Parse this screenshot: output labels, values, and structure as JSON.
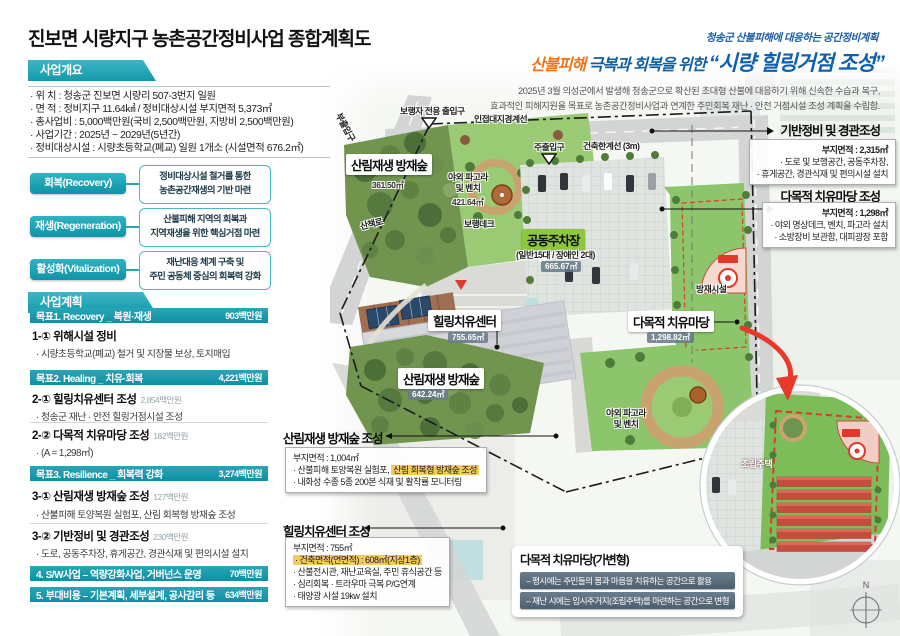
{
  "colors": {
    "accent_teal": "#1ba3b4",
    "slogan_blue": "#0e5fae",
    "slogan_orange": "#ee7318",
    "highlight_yellow": "#f3ca5d",
    "alert_red": "#e8392b",
    "parking_green": "#8dc63f"
  },
  "title": "진보면 시량지구 농촌공간정비사업 종합계획도",
  "slogan": {
    "kicker": "청송군 산불피해에 대응하는 공간정비계획",
    "highlight": "산불피해",
    "mid": " 극복과 회복을 위한 ",
    "quoted": "“시량 힐링거점 조성”",
    "desc1": "2025년 3월 의성군에서 발생해 청송군으로 확산된 초대형 산불에 대응하기 위해 신속한 수습과 복구,",
    "desc2": "효과적인 피해지원을 목표로 농촌공간정비사업과 연계한 주민회복 재난 · 안전 거점시설 조성 계획을 수립함."
  },
  "overview": {
    "tab": "사업개요",
    "items": [
      "· 위    치 : 청송군 진보면 시량리 507-3번지 일원",
      "· 면    적 : 정비지구 11.64㎢ / 정비대상시설 부지면적 5,373㎡",
      "· 총사업비 : 5,000백만원(국비 2,500백만원, 지방비 2,500백만원)",
      "· 사업기간 : 2025년 ~ 2029년(5년간)",
      "· 정비대상시설 : 시량초등학교(폐교) 일원 1개소 (시설면적 676.2㎡)"
    ]
  },
  "strategies": [
    {
      "label": "회복(Recovery)",
      "line1": "정비대상시설 철거를 통한",
      "line2": "농촌공간재생의 기반 마련"
    },
    {
      "label": "재생(Regeneration)",
      "line1": "산불피해 지역의 회복과",
      "line2": "지역재생을 위한 핵심거점 마련"
    },
    {
      "label": "활성화(Vitalization)",
      "line1": "재난대응 체계 구축 및",
      "line2": "주민 공동체 중심의 회복력 강화"
    }
  ],
  "plan": {
    "tab": "사업계획",
    "goal1": {
      "label": "목표1. Recovery _ 복원·재생",
      "amount": "903백만원"
    },
    "item1": {
      "title": "1-① 위해시설 정비",
      "amount": "",
      "sub": "· 시량초등학교(폐교) 철거 및 지장물 보상, 토지매입"
    },
    "goal2": {
      "label": "목표2. Healing _ 치유·회복",
      "amount": "4,221백만원"
    },
    "item2a": {
      "title": "2-① 힐링치유센터 조성",
      "amount": "2,854백만원",
      "sub": "· 청송군 재난 · 안전 힐링거점시설 조성"
    },
    "item2b": {
      "title": "2-② 다목적 치유마당 조성",
      "amount": "182백만원",
      "sub": "· (A = 1,298㎡)"
    },
    "goal3": {
      "label": "목표3. Resilience _ 회복력 강화",
      "amount": "3,274백만원"
    },
    "item3a": {
      "title": "3-① 산림재생 방재숲 조성",
      "amount": "127백만원",
      "sub": "· 산불피해 토양복원 실험포, 산림 회복형 방재숲 조성"
    },
    "item3b": {
      "title": "3-② 기반정비 및 경관조성",
      "amount": "230백만원",
      "sub": "· 도로, 공동주차장, 휴게공간, 경관식재 및 편의시설 설치"
    },
    "row4": {
      "label": "4. S/W사업 – 역량강화사업, 거버넌스 운영",
      "amount": "70백만원"
    },
    "row5": {
      "label": "5. 부대비용 – 기본계획, 세부설계, 공사감리 등",
      "amount": "634백만원"
    }
  },
  "map": {
    "forest_top": {
      "name": "산림재생 방재숲",
      "area": "361.50㎡"
    },
    "pagora_top": {
      "name": "야외 파고라\n및 벤치",
      "area": "421.64㎡"
    },
    "parking": {
      "name": "공동주차장",
      "capacity": "(일반15대 / 장애인 2대)",
      "area": "665.67㎡"
    },
    "facility": "방재시설",
    "healing_center": {
      "name": "힐링치유센터",
      "area": "755.65㎡"
    },
    "madang": {
      "name": "다목적 치유마당",
      "area": "1,298.82㎡"
    },
    "forest_bottom": {
      "name": "산림재생 방재숲",
      "area": "642.24㎡"
    },
    "pagora_bottom": "야외 파고라\n및 벤치",
    "walkway": "산책로",
    "deck": "보행데크",
    "entrance_ped": "보행자 전용 출입구",
    "entrance_main": "주출입구",
    "entrance_sub": "부출입구",
    "boundary_line": "인접대지경계선",
    "building_limit": "건축한계선 (3m)",
    "prefab": "조립주택",
    "compass_n": "N"
  },
  "callouts": {
    "infra": {
      "title": "기반정비 및 경관조성",
      "l1": "부지면적 : 2,315㎡",
      "l2": "· 도로 및 보행공간, 공동주차장,",
      "l3": "· 휴게공간, 경관식재 및 편의시설 설치"
    },
    "madang": {
      "title": "다목적 치유마당 조성",
      "l1": "부지면적 : 1,298㎡",
      "l2": "· 야외 명상데크, 벤치, 파고라 설치",
      "l3": "· 소방장비 보관함, 대피광장 포함"
    },
    "forest": {
      "title": "산림재생 방재숲 조성",
      "l1": "부지면적 : 1,004㎡",
      "l2_pre": "· 산불피해 토양복원 실험포, ",
      "l2_hl": "산림 회복형 방재숲 조성",
      "l3": "· 내화성 수종 5종 200본 식재 및 활착률 모니터링"
    },
    "center": {
      "title": "힐링치유센터 조성",
      "l1": "부지면적 : 755㎡",
      "l2": "· 건축면적(연면적) : 608㎡(지상1층)",
      "l3": "· 산불전시관, 재난교육실, 주민 휴식공간 등",
      "l4": "· 심리회복 · 트라우마 극복 P/G연계",
      "l5": "· 태양광 시설 19kw 설치"
    },
    "flex": {
      "title": "다목적 치유마당(가변형)",
      "bar1": "– 평시에는 주민들의 몸과 마음을 치유하는 공간으로 활용",
      "bar2": "– 재난 시에는 임시주거지(조립주택)를 마련하는 공간으로 변형"
    }
  }
}
